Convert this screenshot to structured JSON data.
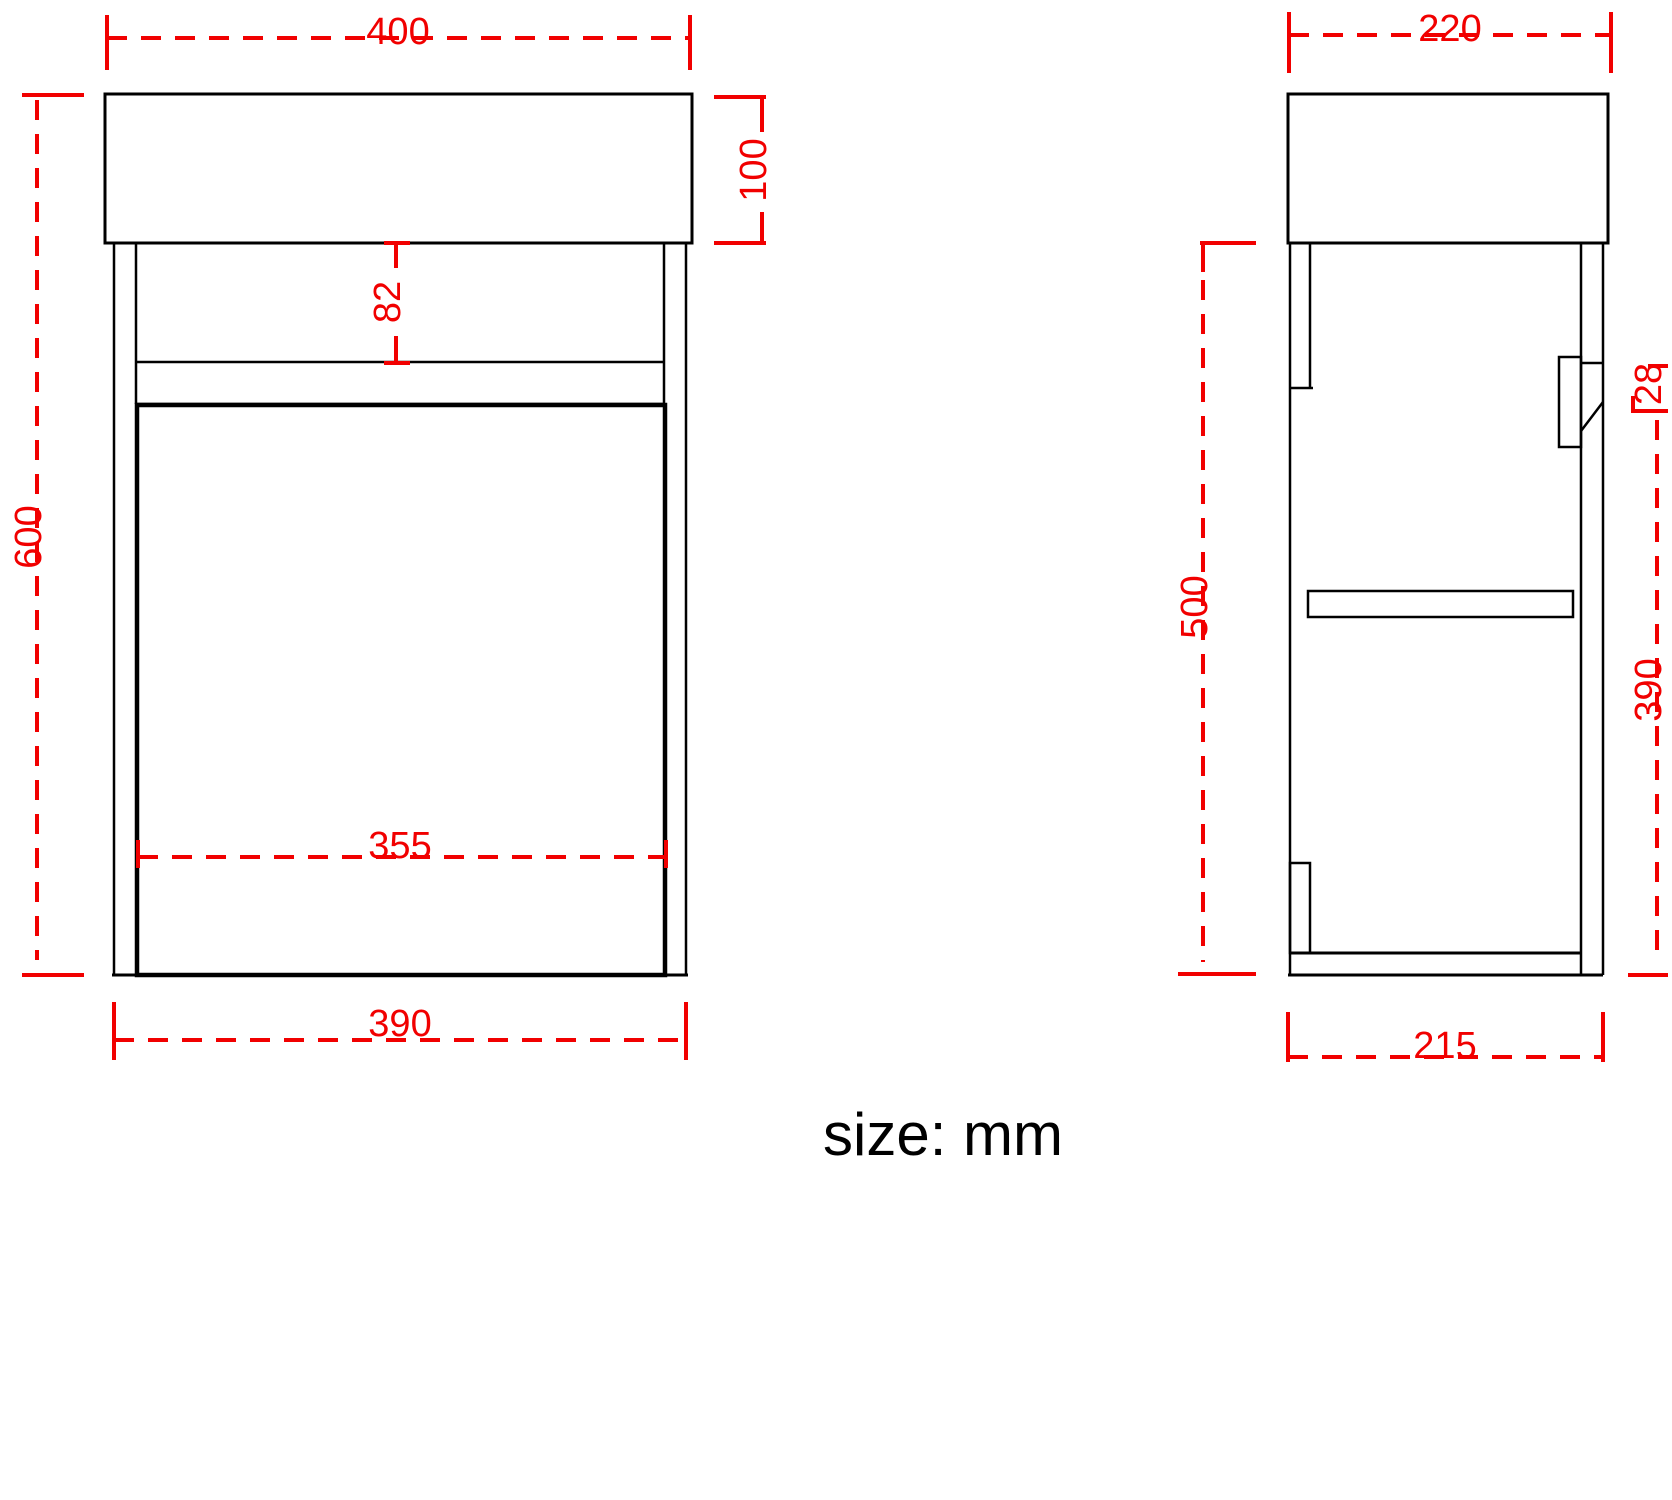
{
  "note": {
    "units": "size: mm"
  },
  "colors": {
    "dimension": "#f10000",
    "line": "#000000"
  },
  "front_view": {
    "dim_top_width": "400",
    "dim_top_height": "100",
    "dim_apron_height": "82",
    "dim_overall_height": "600",
    "dim_door_width": "355",
    "dim_cabinet_width": "390"
  },
  "side_view": {
    "dim_top_depth": "220",
    "dim_handle_recess": "28",
    "dim_cabinet_height": "500",
    "dim_door_height": "390",
    "dim_cabinet_depth": "215"
  }
}
